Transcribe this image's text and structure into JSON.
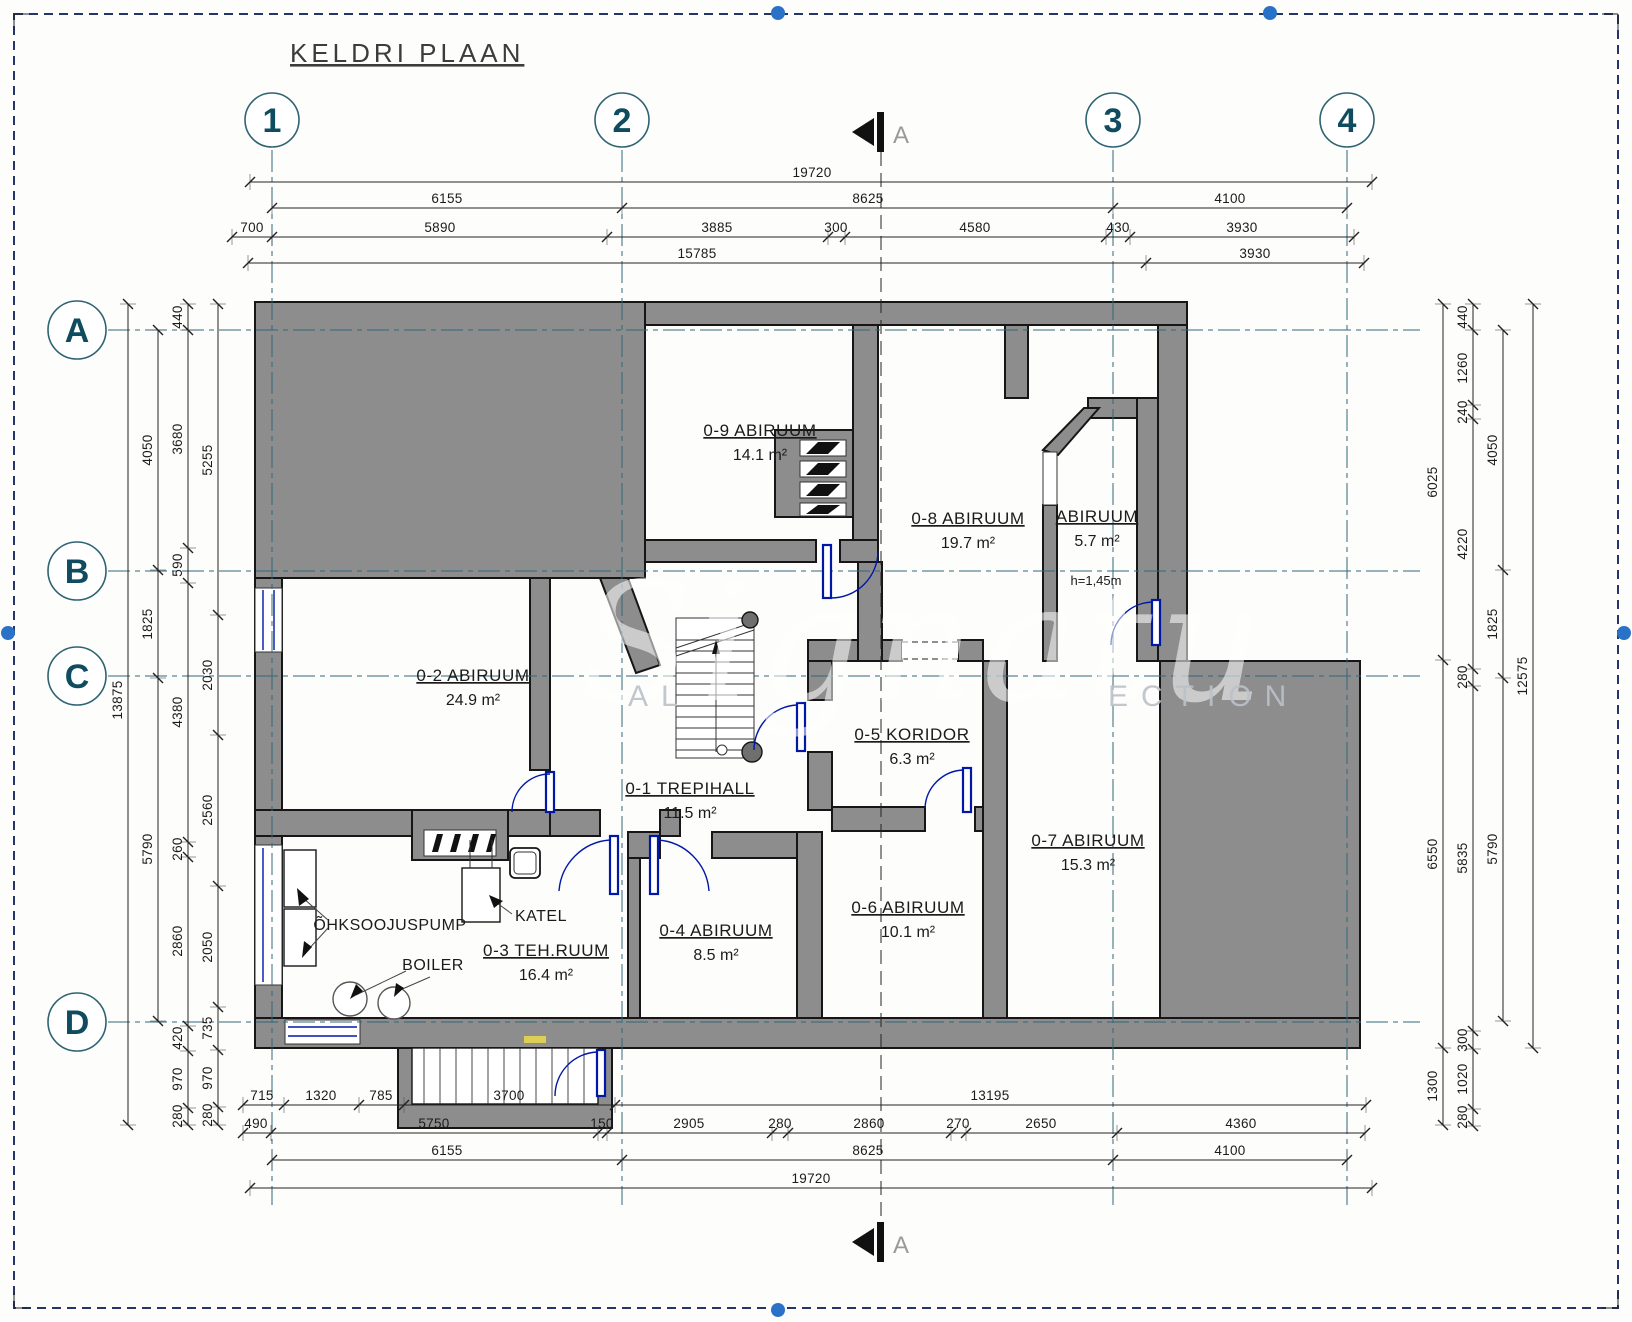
{
  "page": {
    "title": "KELDRI PLAAN"
  },
  "section": {
    "label": "A"
  },
  "grid": {
    "cols": [
      {
        "label": "1"
      },
      {
        "label": "2"
      },
      {
        "label": "3"
      },
      {
        "label": "4"
      }
    ],
    "rows": [
      {
        "label": "A"
      },
      {
        "label": "B"
      },
      {
        "label": "C"
      },
      {
        "label": "D"
      }
    ]
  },
  "rooms": [
    {
      "name": "0-9 ABIRUUM",
      "area": "14.1 m²",
      "cx": 760,
      "cy": 436
    },
    {
      "name": "0-8 ABIRUUM",
      "area": "19.7 m²",
      "cx": 968,
      "cy": 524
    },
    {
      "name": "ABIRUUM",
      "area": "5.7 m²",
      "note": "h=1,45m",
      "cx": 1097,
      "cy": 522,
      "nx": 1096,
      "ny": 585
    },
    {
      "name": "0-2 ABIRUUM",
      "area": "24.9 m²",
      "cx": 473,
      "cy": 681
    },
    {
      "name": "0-1 TREPIHALL",
      "area": "11.5 m²",
      "cx": 690,
      "cy": 794
    },
    {
      "name": "0-5 KORIDOR",
      "area": "6.3 m²",
      "cx": 912,
      "cy": 740
    },
    {
      "name": "0-7 ABIRUUM",
      "area": "15.3 m²",
      "cx": 1088,
      "cy": 846
    },
    {
      "name": "0-6 ABIRUUM",
      "area": "10.1 m²",
      "cx": 908,
      "cy": 913
    },
    {
      "name": "0-4 ABIRUUM",
      "area": "8.5 m²",
      "cx": 716,
      "cy": 936
    },
    {
      "name": "0-3 TEH.RUUM",
      "area": "16.4 m²",
      "cx": 546,
      "cy": 956
    }
  ],
  "equipment": {
    "heat_pump": "ÕHKSOOJUSPUMP",
    "furnace": "KATEL",
    "boiler": "BOILER"
  },
  "watermark": {
    "script": "Signatu",
    "caps_left": "AL",
    "caps_right": "ECTION"
  },
  "dim_chains": [
    {
      "o": "h",
      "line": 182,
      "from": 250,
      "to": 1372,
      "ticks": [
        250,
        1372
      ],
      "labels": [
        {
          "t": "19720",
          "p": 812
        }
      ]
    },
    {
      "o": "h",
      "line": 208,
      "from": 272,
      "to": 1347,
      "ticks": [
        272,
        622,
        1113,
        1347
      ],
      "labels": [
        {
          "t": "6155",
          "p": 447
        },
        {
          "t": "8625",
          "p": 868
        },
        {
          "t": "4100",
          "p": 1230
        }
      ]
    },
    {
      "o": "h",
      "line": 237,
      "from": 232,
      "to": 1354,
      "ticks": [
        232,
        272,
        607,
        828,
        845,
        1106,
        1130,
        1354
      ],
      "labels": [
        {
          "t": "700",
          "p": 252
        },
        {
          "t": "5890",
          "p": 440
        },
        {
          "t": "3885",
          "p": 717
        },
        {
          "t": "300",
          "p": 836
        },
        {
          "t": "4580",
          "p": 975
        },
        {
          "t": "430",
          "p": 1118
        },
        {
          "t": "3930",
          "p": 1242
        }
      ]
    },
    {
      "o": "h",
      "line": 263,
      "from": 248,
      "to": 1364,
      "ticks": [
        248,
        1146,
        1364
      ],
      "labels": [
        {
          "t": "15785",
          "p": 697
        },
        {
          "t": "3930",
          "p": 1255
        }
      ]
    },
    {
      "o": "h",
      "line": 1105,
      "from": 243,
      "to": 1366,
      "ticks": [
        243,
        284,
        359,
        404,
        615,
        1366
      ],
      "labels": [
        {
          "t": "715",
          "p": 262
        },
        {
          "t": "1320",
          "p": 321
        },
        {
          "t": "785",
          "p": 381
        },
        {
          "t": "3700",
          "p": 509
        },
        {
          "t": "13195",
          "p": 990
        }
      ]
    },
    {
      "o": "h",
      "line": 1133,
      "from": 243,
      "to": 1365,
      "ticks": [
        243,
        271,
        598,
        607,
        772,
        788,
        951,
        966,
        1117,
        1365
      ],
      "labels": [
        {
          "t": "490",
          "p": 256
        },
        {
          "t": "5750",
          "p": 434
        },
        {
          "t": "150",
          "p": 602
        },
        {
          "t": "2905",
          "p": 689
        },
        {
          "t": "280",
          "p": 780
        },
        {
          "t": "2860",
          "p": 869
        },
        {
          "t": "270",
          "p": 958
        },
        {
          "t": "2650",
          "p": 1041
        },
        {
          "t": "4360",
          "p": 1241
        }
      ]
    },
    {
      "o": "h",
      "line": 1160,
      "from": 272,
      "to": 1347,
      "ticks": [
        272,
        622,
        1113,
        1347
      ],
      "labels": [
        {
          "t": "6155",
          "p": 447
        },
        {
          "t": "8625",
          "p": 868
        },
        {
          "t": "4100",
          "p": 1230
        }
      ]
    },
    {
      "o": "h",
      "line": 1188,
      "from": 250,
      "to": 1372,
      "ticks": [
        250,
        1372
      ],
      "labels": [
        {
          "t": "19720",
          "p": 811
        }
      ]
    },
    {
      "o": "v",
      "line": 128,
      "from": 304,
      "to": 1125,
      "ticks": [
        304,
        1125
      ],
      "labels": [
        {
          "t": "13875",
          "p": 700
        }
      ]
    },
    {
      "o": "v",
      "line": 158,
      "from": 330,
      "to": 1021,
      "ticks": [
        330,
        570,
        678,
        1021
      ],
      "labels": [
        {
          "t": "4050",
          "p": 450
        },
        {
          "t": "1825",
          "p": 624
        },
        {
          "t": "5790",
          "p": 849
        }
      ]
    },
    {
      "o": "v",
      "line": 188,
      "from": 304,
      "to": 1125,
      "ticks": [
        304,
        330,
        548,
        583,
        842,
        857,
        1026,
        1051,
        1108,
        1125
      ],
      "labels": [
        {
          "t": "440",
          "p": 317
        },
        {
          "t": "3680",
          "p": 439
        },
        {
          "t": "590",
          "p": 565
        },
        {
          "t": "4380",
          "p": 712
        },
        {
          "t": "260",
          "p": 849
        },
        {
          "t": "2860",
          "p": 941
        },
        {
          "t": "420",
          "p": 1038
        },
        {
          "t": "970",
          "p": 1079
        },
        {
          "t": "280",
          "p": 1116
        }
      ]
    },
    {
      "o": "v",
      "line": 218,
      "from": 304,
      "to": 1125,
      "ticks": [
        304,
        615,
        735,
        886,
        1007,
        1050,
        1107,
        1125
      ],
      "labels": [
        {
          "t": "5255",
          "p": 460
        },
        {
          "t": "2030",
          "p": 675
        },
        {
          "t": "2560",
          "p": 810
        },
        {
          "t": "2050",
          "p": 947
        },
        {
          "t": "735",
          "p": 1028
        },
        {
          "t": "970",
          "p": 1078
        },
        {
          "t": "280",
          "p": 1115
        }
      ]
    },
    {
      "o": "v",
      "line": 1443,
      "from": 304,
      "to": 1125,
      "ticks": [
        304,
        660,
        1048,
        1125
      ],
      "labels": [
        {
          "t": "6025",
          "p": 482
        },
        {
          "t": "6550",
          "p": 854
        },
        {
          "t": "1300",
          "p": 1086
        }
      ]
    },
    {
      "o": "v",
      "line": 1473,
      "from": 304,
      "to": 1126,
      "ticks": [
        304,
        330,
        405,
        419,
        669,
        686,
        1031,
        1049,
        1109,
        1126
      ],
      "labels": [
        {
          "t": "440",
          "p": 317
        },
        {
          "t": "1260",
          "p": 368
        },
        {
          "t": "240",
          "p": 412
        },
        {
          "t": "4220",
          "p": 544
        },
        {
          "t": "280",
          "p": 677
        },
        {
          "t": "5835",
          "p": 858
        },
        {
          "t": "300",
          "p": 1040
        },
        {
          "t": "1020",
          "p": 1079
        },
        {
          "t": "280",
          "p": 1117
        }
      ]
    },
    {
      "o": "v",
      "line": 1503,
      "from": 330,
      "to": 1021,
      "ticks": [
        330,
        570,
        678,
        1021
      ],
      "labels": [
        {
          "t": "4050",
          "p": 450
        },
        {
          "t": "1825",
          "p": 624
        },
        {
          "t": "5790",
          "p": 849
        }
      ]
    },
    {
      "o": "v",
      "line": 1533,
      "from": 304,
      "to": 1048,
      "ticks": [
        304,
        1048
      ],
      "labels": [
        {
          "t": "12575",
          "p": 676
        }
      ]
    }
  ]
}
